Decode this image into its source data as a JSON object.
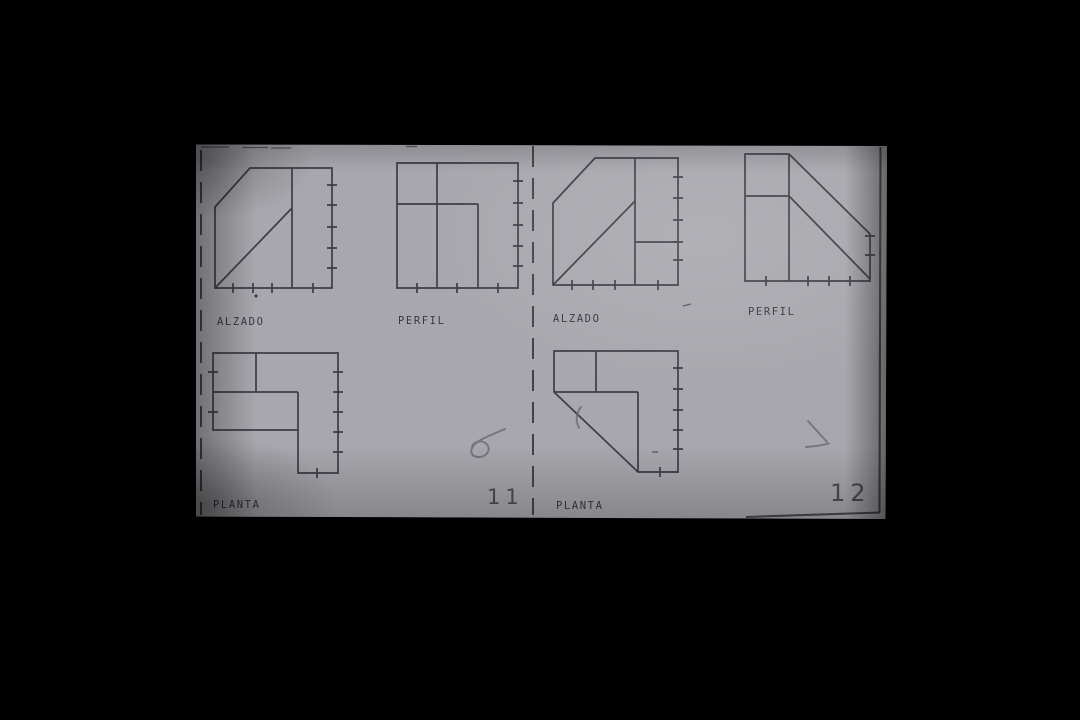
{
  "scene": {
    "background_color": "#000000",
    "paper_color": "#a7a7ad",
    "ink_color": "#3d3d47",
    "label_color": "#383842",
    "number_color": "#4d4d57",
    "pencil_color": "#6b6b73",
    "description": "Photograph of a printed orthographic-projection worksheet on black background"
  },
  "exercises": [
    {
      "number": "11",
      "views": [
        {
          "id": "alzado",
          "label": "ALZADO"
        },
        {
          "id": "perfil",
          "label": "PERFIL"
        },
        {
          "id": "planta",
          "label": "PLANTA"
        }
      ]
    },
    {
      "number": "12",
      "views": [
        {
          "id": "alzado",
          "label": "ALZADO"
        },
        {
          "id": "perfil",
          "label": "PERFIL"
        },
        {
          "id": "planta",
          "label": "PLANTA"
        }
      ]
    }
  ]
}
